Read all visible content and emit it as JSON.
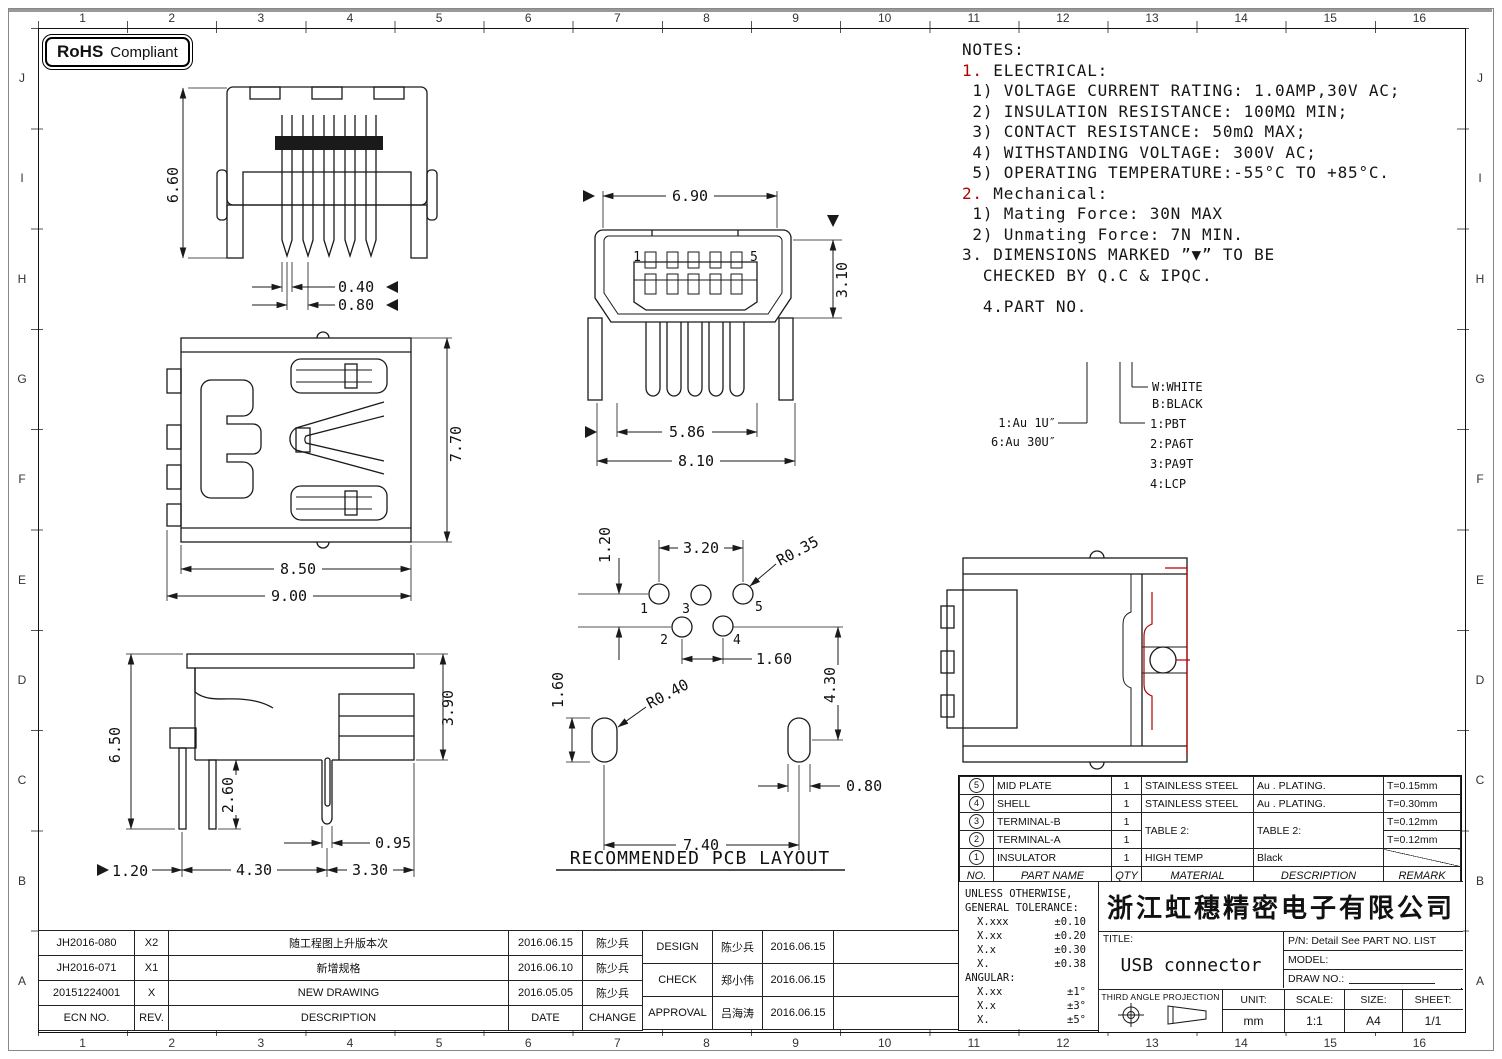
{
  "border": {
    "cols": [
      "1",
      "2",
      "3",
      "4",
      "5",
      "6",
      "7",
      "8",
      "9",
      "10",
      "11",
      "12",
      "13",
      "14",
      "15",
      "16"
    ],
    "rows": [
      "J",
      "I",
      "H",
      "G",
      "F",
      "E",
      "D",
      "C",
      "B",
      "A"
    ]
  },
  "rohs": {
    "bold": "RoHS",
    "text": "Compliant"
  },
  "notes": {
    "l0": "NOTES:",
    "l1a": "1.",
    "l1b": " ELECTRICAL:",
    "l2": " 1) VOLTAGE CURRENT RATING: 1.0AMP,30V AC;",
    "l3": " 2) INSULATION RESISTANCE: 100MΩ MIN;",
    "l4": " 3) CONTACT RESISTANCE: 50mΩ MAX;",
    "l5": " 4) WITHSTANDING VOLTAGE: 300V AC;",
    "l6": " 5) OPERATING TEMPERATURE:-55°C TO +85°C.",
    "l7a": "2.",
    "l7b": " Mechanical:",
    "l8": " 1) Mating Force: 30N MAX",
    "l9": " 2) Unmating Force: 7N MIN.",
    "l10": "3. DIMENSIONS MARKED ”▼” TO BE",
    "l11": "  CHECKED BY Q.C & IPQC.",
    "l12": "  4.PART NO."
  },
  "tree": {
    "au1": "1:Au 1U″",
    "au2": "6:Au 30U″",
    "w": "W:WHITE",
    "b": "B:BLACK",
    "m1": "1:PBT",
    "m2": "2:PA6T",
    "m3": "3:PA9T",
    "m4": "4:LCP"
  },
  "dims": {
    "front": {
      "h": "6.60",
      "pw": "0.40",
      "pp": "0.80"
    },
    "top": {
      "h": "7.70",
      "w1": "8.50",
      "w2": "9.00"
    },
    "side": {
      "h": "6.50",
      "p": "2.60",
      "rh": "3.90",
      "sw": "0.95",
      "m": "1.20",
      "a": "4.30",
      "b": "3.30"
    },
    "face": {
      "w": "6.90",
      "h": "3.10",
      "w1": "5.86",
      "w2": "8.10",
      "p1": "1",
      "p5": "5"
    },
    "pcb": {
      "v": "1.20",
      "t": "3.20",
      "r1": "R0.35",
      "p": "1.60",
      "sh": "1.60",
      "r2": "R0.40",
      "rv": "4.30",
      "sw": "0.80",
      "span": "7.40",
      "n1": "1",
      "n2": "2",
      "n3": "3",
      "n4": "4",
      "n5": "5",
      "title": "RECOMMENDED PCB LAYOUT"
    }
  },
  "parts": {
    "headers": [
      "NO.",
      "PART NAME",
      "QTY",
      "MATERIAL",
      "DESCRIPTION",
      "REMARK"
    ],
    "rows": [
      {
        "no": "5",
        "name": "MID PLATE",
        "qty": "1",
        "mat": "STAINLESS STEEL",
        "desc": "Au . PLATING.",
        "rem": "T=0.15mm"
      },
      {
        "no": "4",
        "name": "SHELL",
        "qty": "1",
        "mat": "STAINLESS STEEL",
        "desc": "Au . PLATING.",
        "rem": "T=0.30mm"
      },
      {
        "no": "3",
        "name": "TERMINAL-B",
        "qty": "1",
        "mat": "TABLE 2:",
        "desc": "TABLE 2:",
        "rem": "T=0.12mm"
      },
      {
        "no": "2",
        "name": "TERMINAL-A",
        "qty": "1",
        "rem": "T=0.12mm"
      },
      {
        "no": "1",
        "name": "INSULATOR",
        "qty": "1",
        "mat": "HIGH TEMP",
        "desc": "Black",
        "rem": ""
      }
    ]
  },
  "tolerance": {
    "t1": "UNLESS OTHERWISE,",
    "t2": "GENERAL TOLERANCE:",
    "r1l": "X.xxx",
    "r1v": "±0.10",
    "r2l": "X.xx",
    "r2v": "±0.20",
    "r3l": "X.x",
    "r3v": "±0.30",
    "r4l": "X.",
    "r4v": "±0.38",
    "ang": "ANGULAR:",
    "a1l": "X.xx",
    "a1v": "±1°",
    "a2l": "X.x",
    "a2v": "±3°",
    "a3l": "X.",
    "a3v": "±5°"
  },
  "titleblock": {
    "company": "浙江虹穗精密电子有限公司",
    "title_label": "TITLE:",
    "title": "USB connector",
    "pn": "P/N: Detail See PART NO. LIST",
    "model": "MODEL:",
    "draw": "DRAW NO.:",
    "proj": "THIRD ANGLE PROJECTION",
    "unit_l": "UNIT:",
    "unit": "mm",
    "scale_l": "SCALE:",
    "scale": "1:1",
    "size_l": "SIZE:",
    "size": "A4",
    "sheet_l": "SHEET:",
    "sheet": "1/1"
  },
  "revisions": {
    "h": [
      "ECN NO.",
      "REV.",
      "DESCRIPTION",
      "DATE",
      "CHANGE"
    ],
    "rows": [
      [
        "JH2016-080",
        "X2",
        "随工程图上升版本次",
        "2016.06.15",
        "陈少兵"
      ],
      [
        "JH2016-071",
        "X1",
        "新增规格",
        "2016.06.10",
        "陈少兵"
      ],
      [
        "20151224001",
        "X",
        "NEW DRAWING",
        "2016.05.05",
        "陈少兵"
      ]
    ]
  },
  "approvals": {
    "rows": [
      [
        "DESIGN",
        "陈少兵",
        "2016.06.15"
      ],
      [
        "CHECK",
        "郑小伟",
        "2016.06.15"
      ],
      [
        "APPROVAL",
        "吕海涛",
        "2016.06.15"
      ]
    ]
  }
}
